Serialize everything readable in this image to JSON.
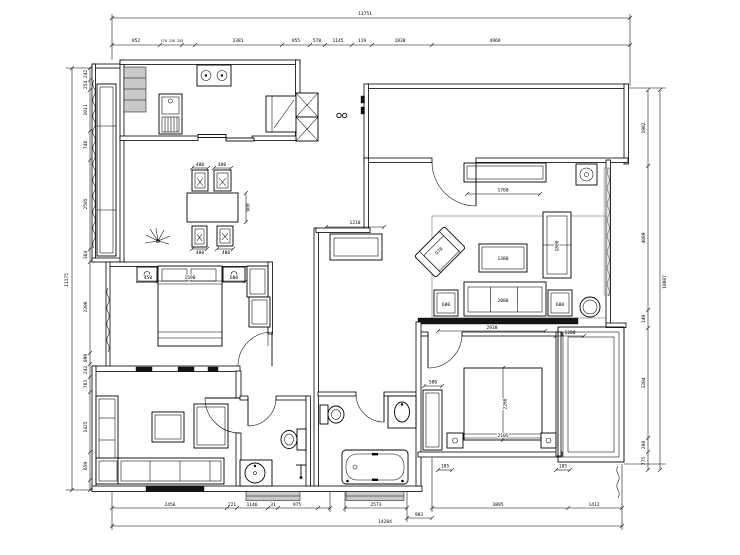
{
  "drawing": {
    "type": "residential floor plan",
    "dims": {
      "top_overall": "13751",
      "top_chain": [
        "952",
        "170 226 253",
        "3381",
        "955",
        "578",
        "1145",
        "119",
        "1838",
        "4969"
      ],
      "bottom_chain": [
        "2456",
        "221",
        "1146",
        "31",
        "975",
        "2573",
        "983",
        "3895",
        "1412"
      ],
      "bottom_overall": "14204",
      "left_overall": "11175",
      "left_chain": [
        "242",
        "254",
        "1011",
        "748",
        "2505",
        "364",
        "2306",
        "899",
        "242",
        "763",
        "1425",
        "659"
      ],
      "right_overall": "10807",
      "right_chain": [
        "1982",
        "4089",
        "149",
        "3304",
        "260",
        "775"
      ],
      "dining": {
        "chair_w1": "480",
        "chair_w2": "480",
        "chair_w3": "480",
        "chair_w4": "480",
        "table_d": "900"
      },
      "hall": {
        "cabinet_w": "1210"
      },
      "living": {
        "tv_cabinet": "1760",
        "armchair": "970",
        "coffee_table": "1380",
        "side_sofa": "1800",
        "sofa": "2080",
        "end_table_left": "600",
        "end_table_right": "600",
        "floor_w": "2938",
        "floor_r": "1200"
      },
      "master": {
        "nightstand_left": "450",
        "bed": "1590",
        "nightstand_right": "600"
      },
      "bedroom2": {
        "wardrobe": "580",
        "bed_l": "2268",
        "bed_w": "2105",
        "gap_left": "185",
        "gap_right": "185"
      }
    }
  }
}
